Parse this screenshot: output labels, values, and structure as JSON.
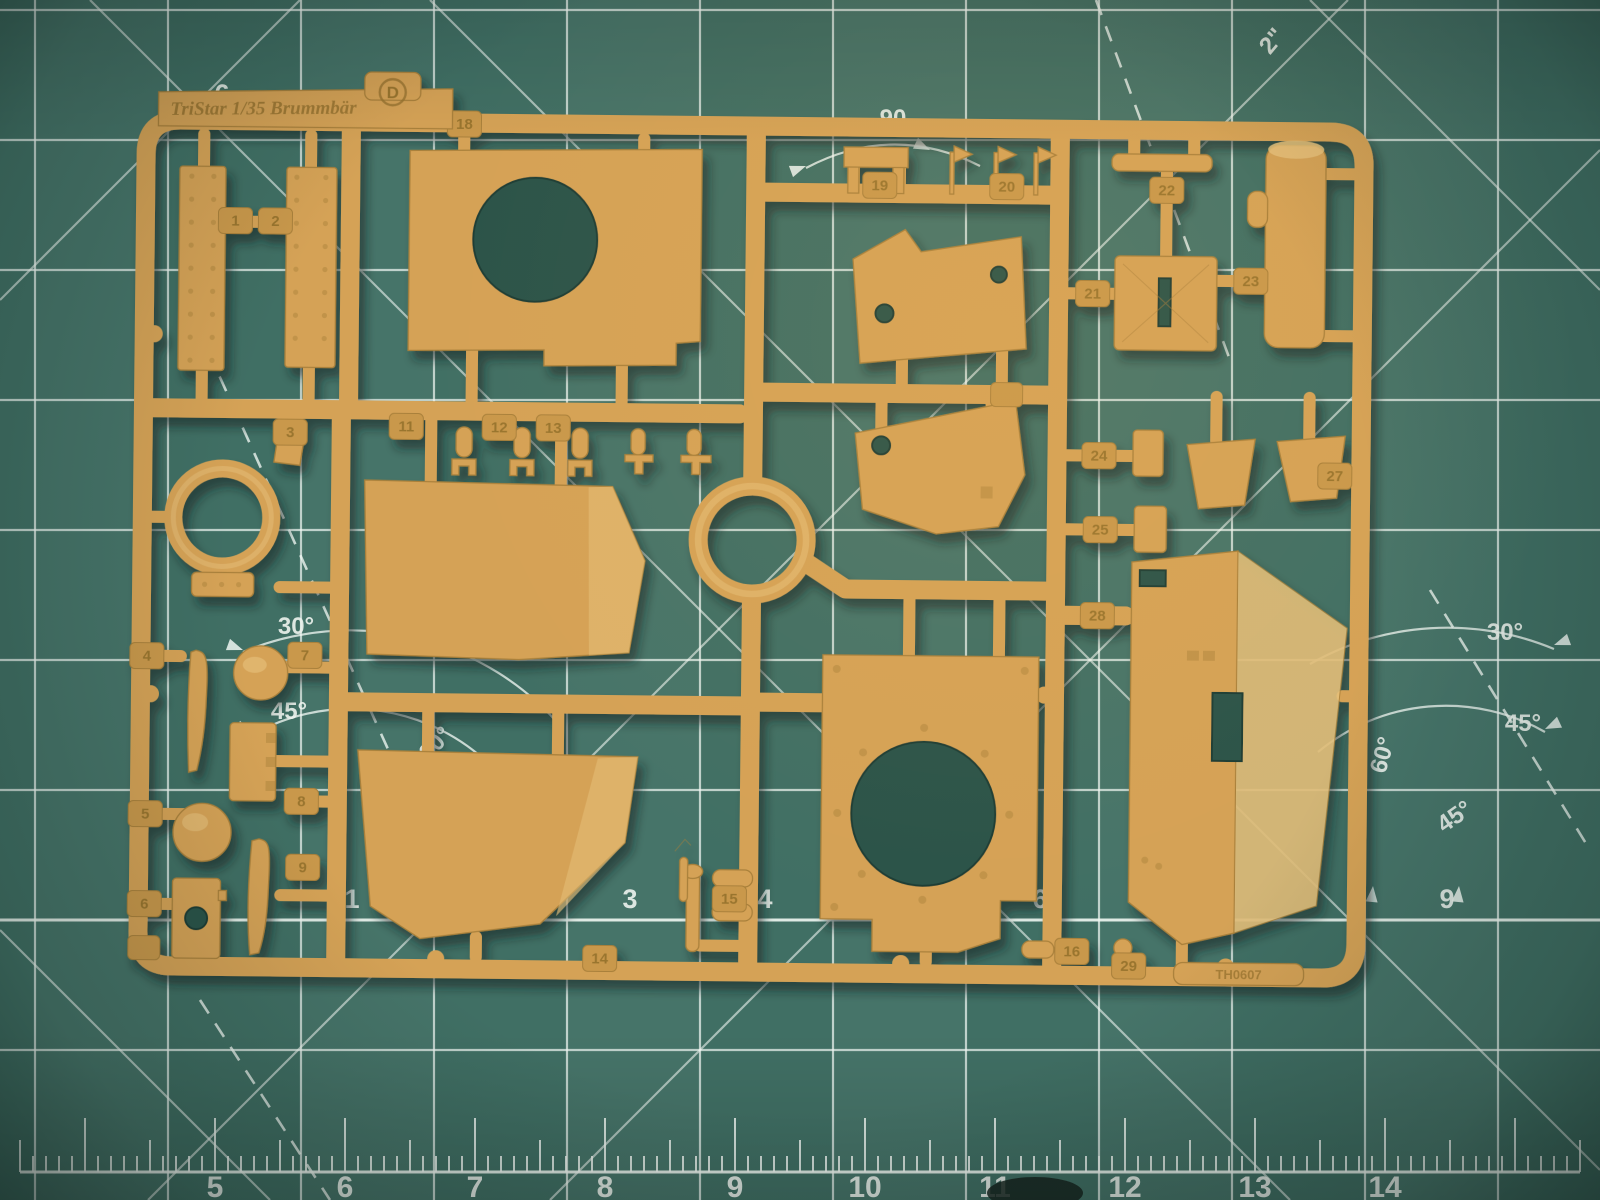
{
  "colors": {
    "mat": "#40706 4",
    "mat-base": "#406f64",
    "hole": "#2b5249",
    "sprue": "#d5a257",
    "sprue-light": "#e7c27c",
    "sprue-dark": "#a9803a",
    "tag": "#c9984b",
    "emboss": "#99742f"
  },
  "sprue": {
    "brand_text": "TriStar 1/35 Brummbär",
    "letter": "D",
    "mold_stamp": "TH0607",
    "part_numbers": [
      "1",
      "2",
      "3",
      "4",
      "5",
      "6",
      "7",
      "8",
      "9",
      "11",
      "12",
      "13",
      "14",
      "15",
      "16",
      "18",
      "19",
      "20",
      "21",
      "22",
      "23",
      "24",
      "25",
      "27",
      "28",
      "29"
    ]
  },
  "mat": {
    "protractor_label": "90",
    "inch_label": "2\"",
    "top_ruler_label": "6",
    "angle_labels": [
      "30°",
      "45°",
      "60°",
      "30°",
      "45°",
      "60°",
      "45°"
    ],
    "mid_ruler_numbers": [
      "1",
      "3",
      "4",
      "6",
      "9"
    ],
    "bottom_ruler_numbers": [
      "5",
      "6",
      "7",
      "8",
      "9",
      "10",
      "11",
      "12",
      "13",
      "14"
    ]
  }
}
